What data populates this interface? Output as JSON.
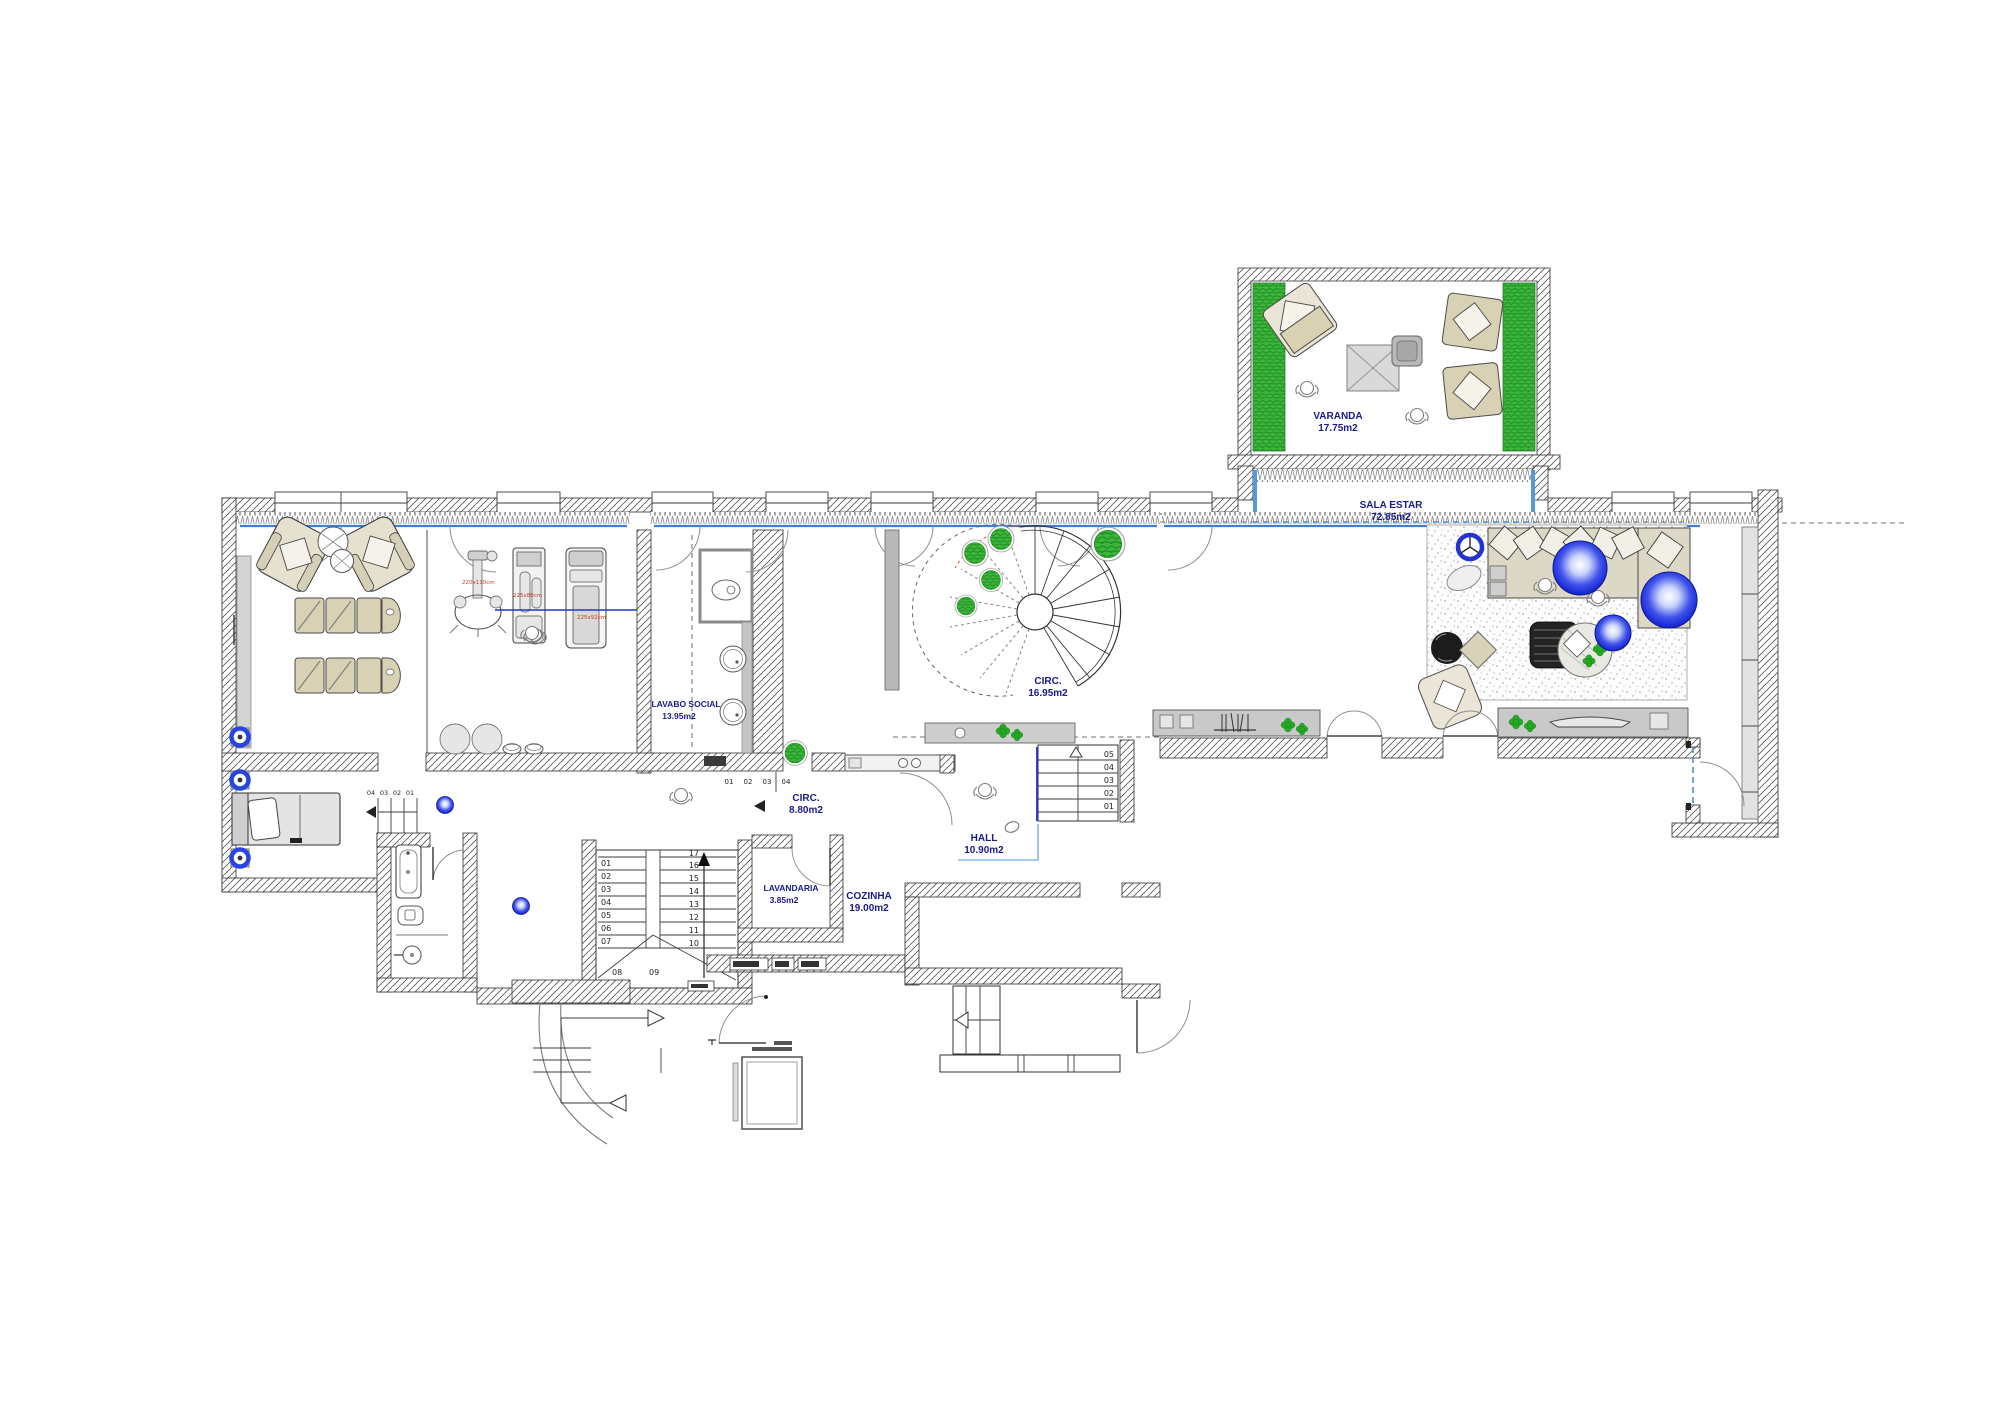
{
  "drawing": {
    "type": "residential-floor-plan"
  },
  "colors": {
    "label_navy": "#1a1a8c",
    "dimension_red": "#c8402e",
    "plant_green": "#2ca52c",
    "service_blue_line": "#3d7fd6",
    "sphere_blue": "#1726d8",
    "wall_line": "#2e2e2e",
    "furniture_beige": "#d9d1b4"
  },
  "rooms": {
    "varanda": {
      "name": "VARANDA",
      "area": "17.75m2"
    },
    "sala_estar": {
      "name": "SALA ESTAR",
      "area": "72.85m2"
    },
    "circ_main": {
      "name": "CIRC.",
      "area": "16.95m2"
    },
    "circ_lower": {
      "name": "CIRC.",
      "area": "8.80m2"
    },
    "hall": {
      "name": "HALL",
      "area": "10.90m2"
    },
    "lavabo_social": {
      "name": "LAVABO SOCIAL",
      "area": "13.95m2"
    },
    "lavandaria": {
      "name": "LAVANDARIA",
      "area": "3.85m2"
    },
    "cozinha": {
      "name": "COZINHA",
      "area": "19.00m2"
    }
  },
  "stairs": {
    "main_left": [
      "01",
      "02",
      "03",
      "04",
      "05",
      "06",
      "07"
    ],
    "main_winders": [
      "08",
      "09"
    ],
    "main_right": [
      "17",
      "16",
      "15",
      "14",
      "13",
      "12",
      "11",
      "10"
    ],
    "hall_steps": [
      "05",
      "04",
      "03",
      "02",
      "01"
    ],
    "bedroom_steps": [
      "04",
      "03",
      "02",
      "01"
    ],
    "corridor_steps": [
      "01",
      "02",
      "03",
      "04"
    ]
  },
  "equipment_dims": [
    "220x110cm",
    "225x80cm",
    "225x92cm"
  ]
}
